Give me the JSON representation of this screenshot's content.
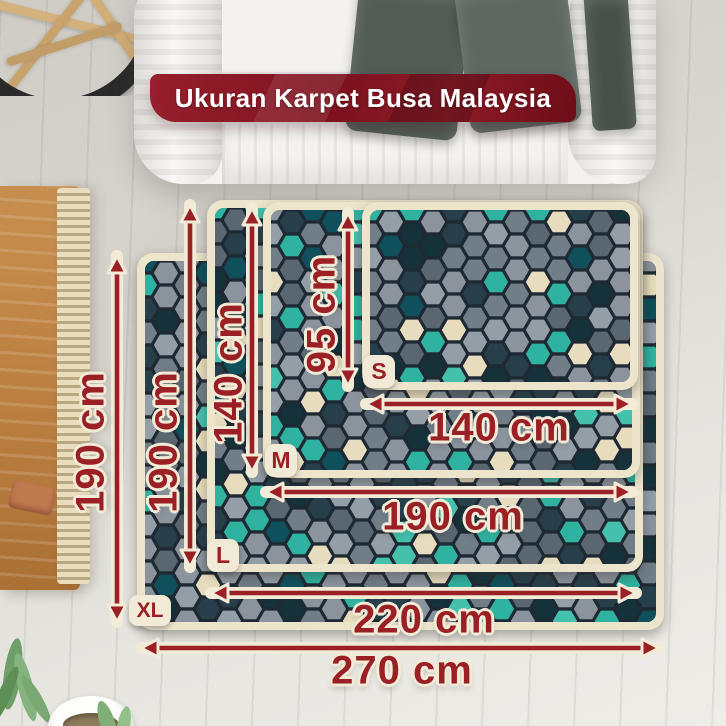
{
  "banner": {
    "title": "Ukuran Karpet Busa Malaysia"
  },
  "rugs": [
    {
      "size": "S",
      "width": "140 cm",
      "height": "95 cm",
      "width_cm": 140,
      "height_cm": 95
    },
    {
      "size": "M",
      "width": "190 cm",
      "height": "140 cm",
      "width_cm": 190,
      "height_cm": 140
    },
    {
      "size": "L",
      "width": "220 cm",
      "height": "190 cm",
      "width_cm": 220,
      "height_cm": 190
    },
    {
      "size": "XL",
      "width": "270 cm",
      "height": "190 cm",
      "width_cm": 270,
      "height_cm": 190
    }
  ],
  "colors": {
    "accent_red": "#9b2025",
    "banner_red_dark": "#6d0d18",
    "cream_outline": "#f2ebd7",
    "rug_border_cream": "#ece4cb",
    "rug_teal": "#2fb3a0",
    "rug_navy": "#15323b",
    "rug_cream_hex": "#e7ddbe"
  }
}
